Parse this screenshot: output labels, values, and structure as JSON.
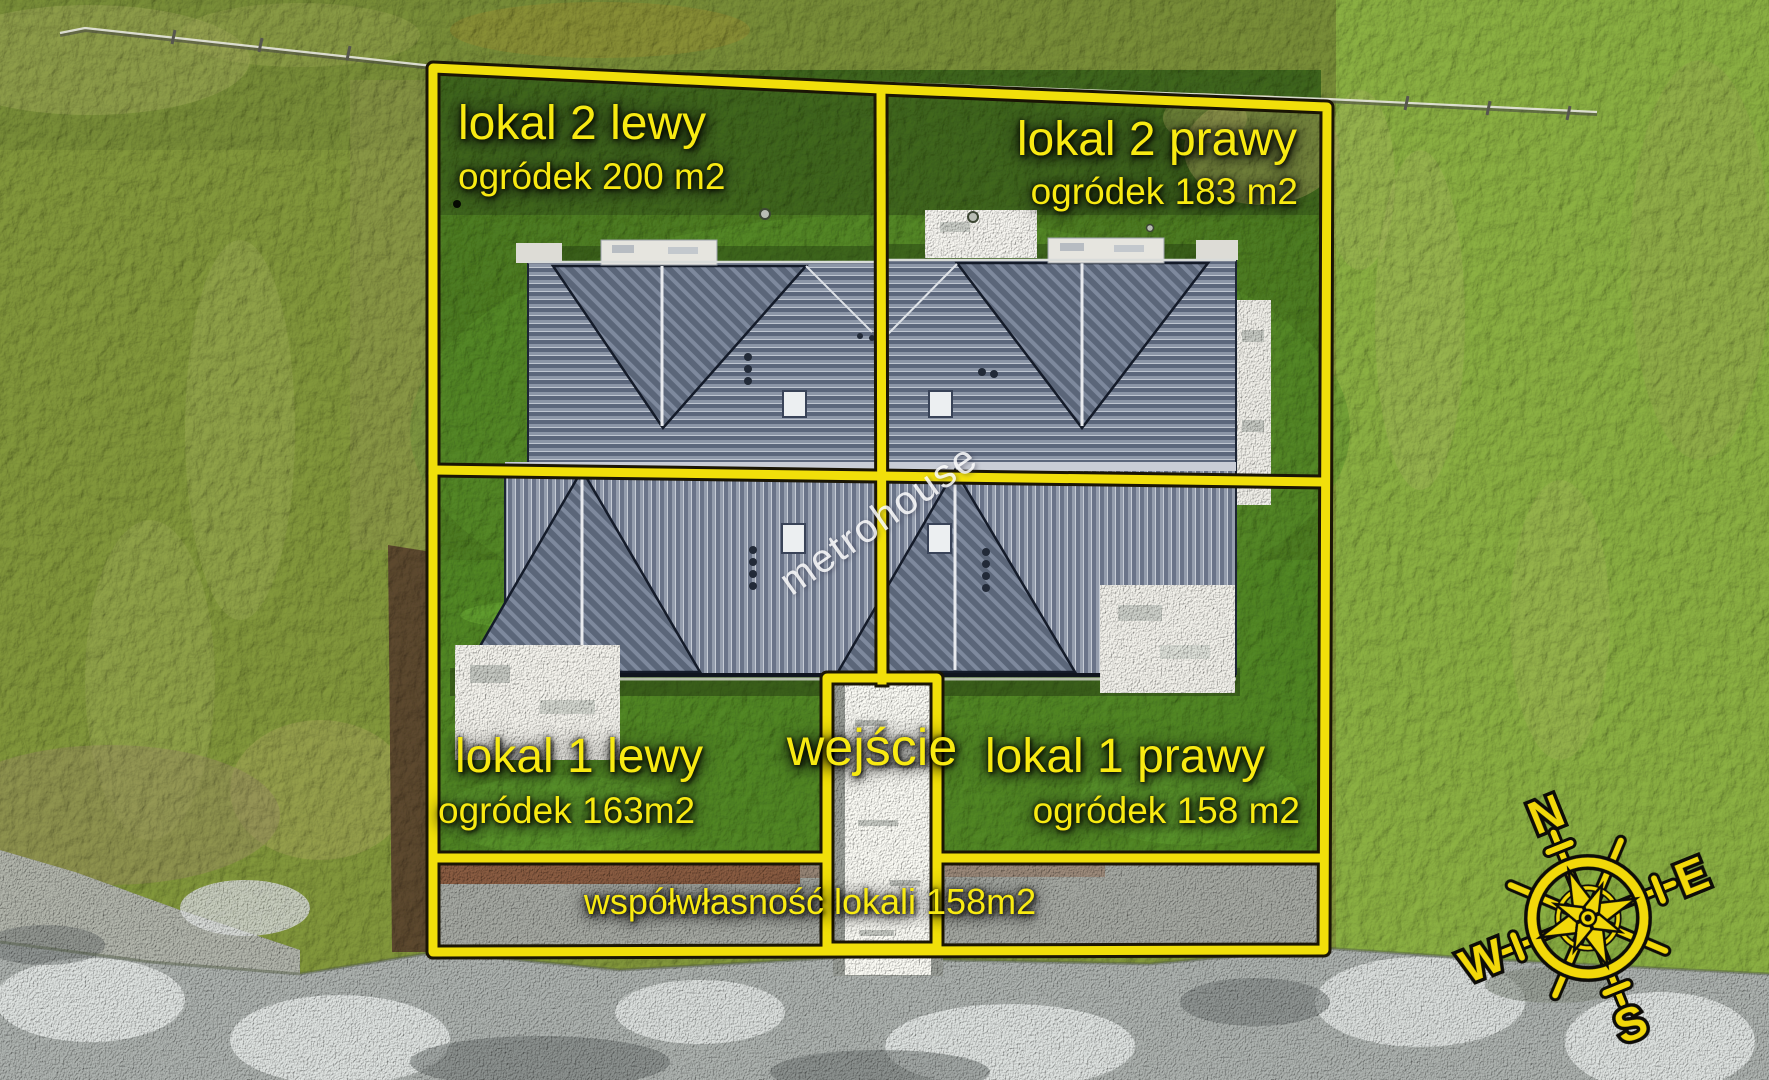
{
  "plots": [
    {
      "name": "lokal 2 lewy",
      "area": "ogródek 200 m2"
    },
    {
      "name": "lokal 2 prawy",
      "area": "ogródek 183 m2"
    },
    {
      "name": "lokal 1 lewy",
      "area": "ogródek 163m2"
    },
    {
      "name": "lokal 1 prawy",
      "area": "ogródek 158 m2"
    }
  ],
  "entrance": {
    "label": "wejście"
  },
  "shared_area": {
    "label": "współwłasność lokali 158m2"
  },
  "watermark": {
    "text": "metrohouse"
  },
  "compass": {
    "north": "N",
    "east": "E",
    "south": "S",
    "west": "W"
  },
  "colors": {
    "annotation_yellow": "#f1df0a",
    "label_text_yellow": "#f8ea12",
    "compass_yellow": "#f2d80a",
    "roof_gray": "#77829a",
    "grass_green": "#4a7a24",
    "gravel_gray": "#a2a7a4",
    "path_white": "#ececE6"
  }
}
